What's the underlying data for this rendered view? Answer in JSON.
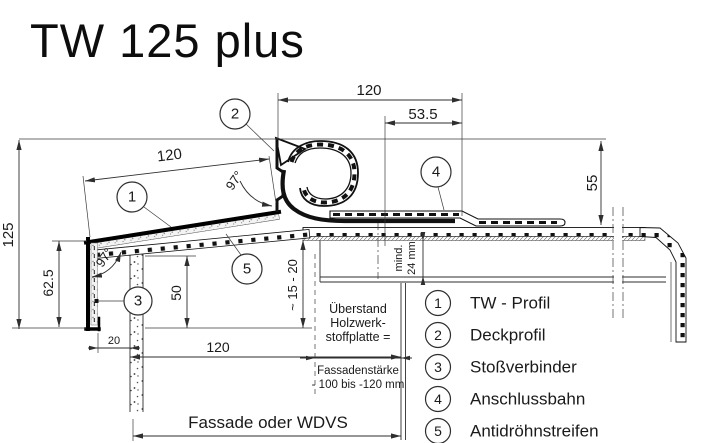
{
  "title": "TW 125 plus",
  "dims": {
    "top_width": "120",
    "top_offset": "53.5",
    "right_height": "55",
    "overall_height": "125",
    "fascia_height": "62.5",
    "slope_width": "120",
    "front_lip": "20",
    "wall_drop": "50",
    "overhang_width": "120",
    "angle_top": "97°",
    "angle_front": "97°",
    "gap": "~ 15 - 20",
    "board_min_a": "mind.",
    "board_min_b": "24 mm",
    "facade_label": "Fassade oder  WDVS",
    "overhang_note_1": "Überstand",
    "overhang_note_2": "Holzwerk-",
    "overhang_note_3": "stoffplatte =",
    "thickness_note_1": "Fassadenstärke",
    "thickness_note_2": "- 100 bis -120 mm"
  },
  "callouts": {
    "c1": "1",
    "c2": "2",
    "c3": "3",
    "c4": "4",
    "c5": "5"
  },
  "legend": {
    "items": [
      {
        "num": "1",
        "label": "TW - Profil"
      },
      {
        "num": "2",
        "label": "Deckprofil"
      },
      {
        "num": "3",
        "label": "Stoßverbinder"
      },
      {
        "num": "4",
        "label": "Anschlussbahn"
      },
      {
        "num": "5",
        "label": "Antidröhnstreifen"
      }
    ]
  }
}
